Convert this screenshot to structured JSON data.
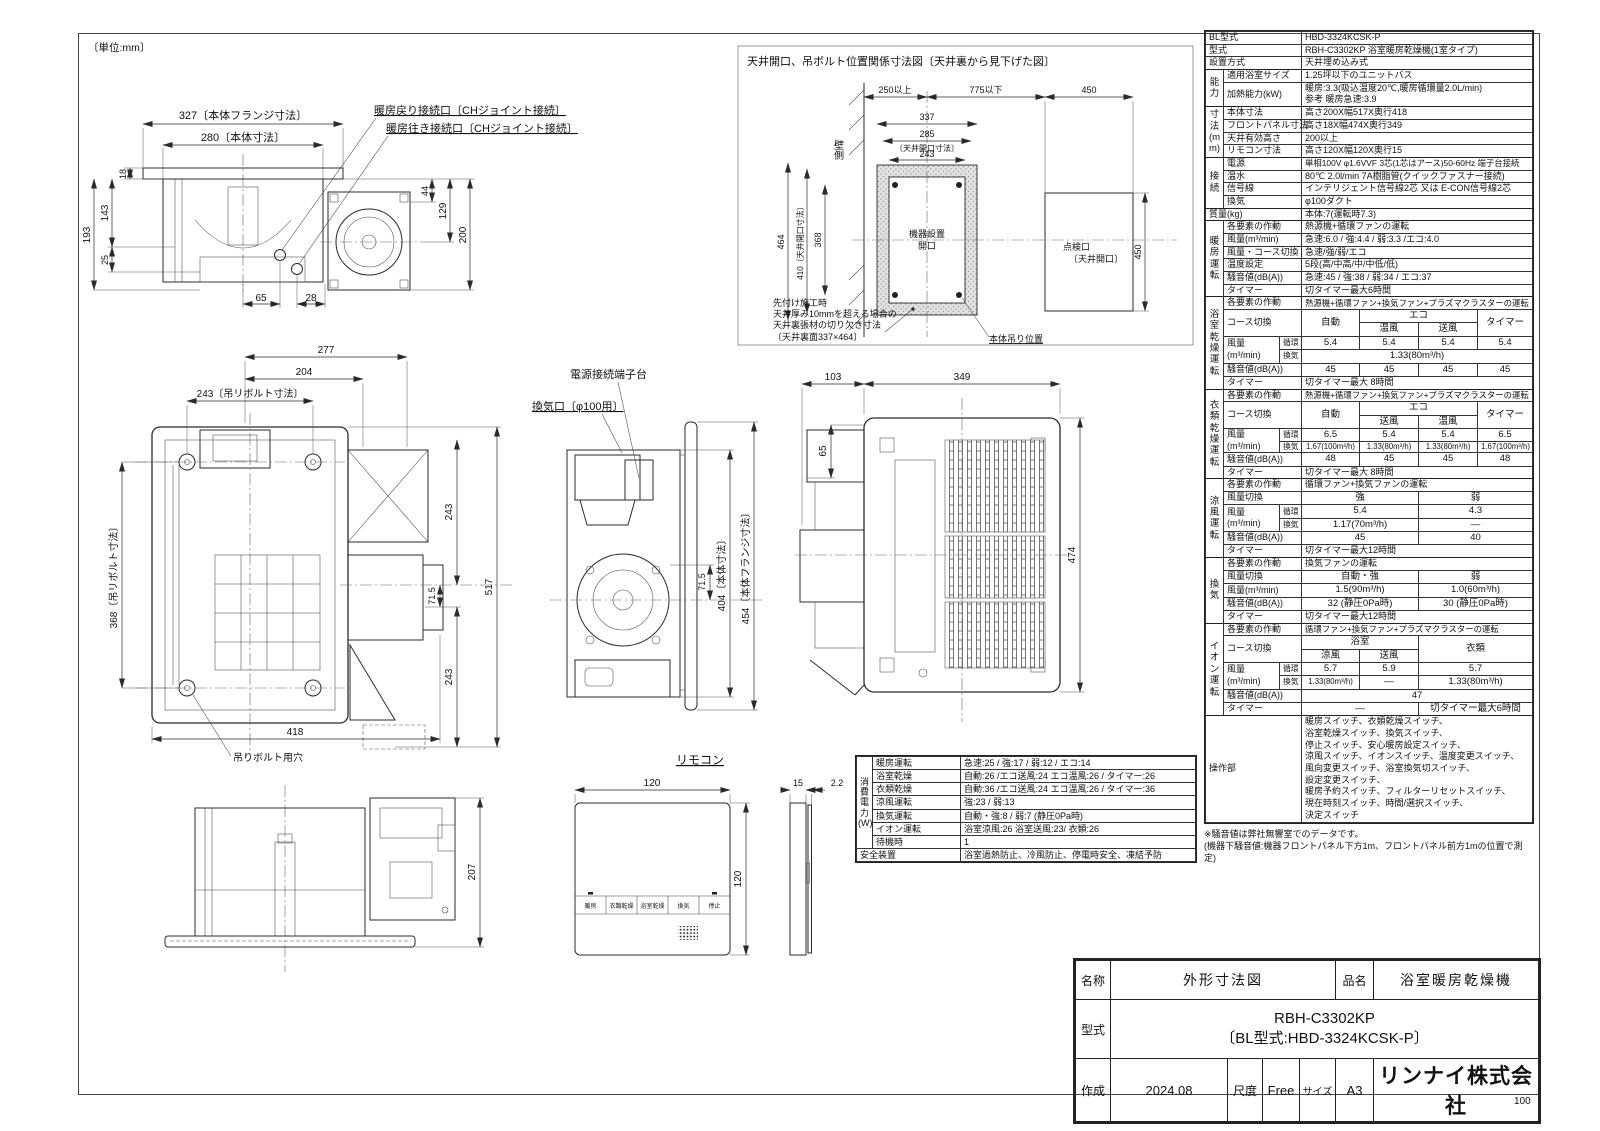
{
  "unit_note": "〔単位:mm〕",
  "page_number": "100",
  "views": {
    "front": {
      "dims": {
        "flange": "327〔本体フランジ寸法〕",
        "body": "280〔本体寸法〕",
        "d18": "18",
        "d193": "193",
        "d143": "143",
        "d25": "25",
        "d65": "65",
        "d28": "28",
        "d44": "44",
        "d129": "129",
        "d200": "200"
      },
      "labels": {
        "ch_return": "暖房戻り接続口〔CHジョイント接続〕",
        "ch_supply": "暖房往き接続口〔CHジョイント接続〕"
      }
    },
    "ceiling": {
      "title": "天井開口、吊ボルト位置関係寸法図〔天井裏から見下げた図〕",
      "dims": {
        "d250": "250以上",
        "d775": "775以下",
        "d450t": "450",
        "d337": "337",
        "d285": "285",
        "d285n": "〔天井開口寸法〕",
        "d243": "243",
        "d464": "464",
        "d410": "410〔天井開口寸法〕",
        "d368": "368",
        "d450r": "450"
      },
      "labels": {
        "wall": "壁側",
        "open1": "機器設置",
        "open2": "開口",
        "insp1": "点検口",
        "insp2": "〔天井開口〕",
        "note1": "先付け施工時",
        "note2": "天井厚み10mmを超える場合の",
        "note3": "天井裏張材の切り欠き寸法",
        "note4": "〔天井裏面337×464〕",
        "hang": "本体吊り位置"
      }
    },
    "top": {
      "dims": {
        "d277": "277",
        "d204": "204",
        "d243bolt": "243〔吊リボルト寸法〕",
        "d368bolt": "368〔吊リボルト寸法〕",
        "d418": "418",
        "d243a": "243",
        "d715": "71.5",
        "d517": "517",
        "d243b": "243"
      },
      "labels": {
        "bolt_hole": "吊りボルト用穴"
      }
    },
    "side": {
      "labels": {
        "terminal": "電源接続端子台",
        "vent": "換気口〔φ100用〕"
      },
      "dims": {
        "d715": "71.5",
        "d404": "404〔本体寸法〕",
        "d454": "454〔本体フランジ寸法〕"
      }
    },
    "panel": {
      "dims": {
        "d103": "103",
        "d349": "349",
        "d65": "65",
        "d474": "474"
      }
    },
    "side2": {
      "dims": {
        "d207": "207"
      }
    },
    "remote": {
      "title": "リモコン",
      "dims": {
        "w": "120",
        "h": "120",
        "t1": "15",
        "t2": "2.2"
      },
      "buttons": [
        "暖房",
        "衣類乾燥",
        "浴室乾燥",
        "換気",
        "停止"
      ]
    }
  },
  "spec": {
    "basic": [
      {
        "l": "BL型式",
        "v": "HBD-3324KCSK-P"
      },
      {
        "l": "型式",
        "v": "RBH-C3302KP 浴室暖房乾燥機(1室タイプ)"
      },
      {
        "l": "設置方式",
        "v": "天井埋め込み式"
      }
    ],
    "cap": {
      "g": "能力",
      "rows": [
        {
          "l": "適用浴室サイズ",
          "v": "1.25坪以下のユニットバス"
        },
        {
          "l": "加熱能力(kW)",
          "v": "暖房:3.3(吸込温度20℃,暖房循環量2.0L/min)",
          "v2": "参考 暖房急速:3.9"
        }
      ]
    },
    "dim": {
      "g": "寸法(mm)",
      "rows": [
        {
          "l": "本体寸法",
          "v": "高さ200X幅517X奥行418"
        },
        {
          "l": "フロントパネル寸法",
          "v": "高さ18X幅474X奥行349"
        },
        {
          "l": "天井有効高さ",
          "v": "200以上"
        },
        {
          "l": "リモコン寸法",
          "v": "高さ120X幅120X奥行15"
        }
      ]
    },
    "conn": {
      "g": "接続",
      "rows": [
        {
          "l": "電源",
          "v": "単相100V φ1.6VVF 3芯(1芯はアース)50-60Hz 端子台接続"
        },
        {
          "l": "温水",
          "v": "80℃ 2.0l/min 7A樹脂管(クイックファスナー接続)"
        },
        {
          "l": "信号線",
          "v": "インテリジェント信号線2芯 又は E-CON信号線2芯"
        },
        {
          "l": "換気",
          "v": "φ100ダクト"
        }
      ]
    },
    "mass": {
      "l": "質量(kg)",
      "v": "本体:7(運転時7.3)"
    },
    "heat": {
      "g": "暖房運転",
      "rows": [
        {
          "l": "各要素の作動",
          "v": "熱源機+循環ファンの運転"
        },
        {
          "l": "風量(m³/min)",
          "v": "急速:6.0 / 強:4.4 / 弱:3.3 /エコ:4.0"
        },
        {
          "l": "風量・コース切換",
          "v": "急速/強/弱/エコ"
        },
        {
          "l": "温度設定",
          "v": "5段(高/中高/中/中低/低)"
        },
        {
          "l": "騒音値(dB(A))",
          "v": "急速:45 / 強:38 / 弱:34 / エコ:37"
        },
        {
          "l": "タイマー",
          "v": "切タイマー最大6時間"
        }
      ]
    },
    "common": {
      "sakudo": "各要素の作動",
      "course": "コース切換",
      "auto": "自動",
      "eco": "エコ",
      "timer_h": "タイマー",
      "furyo": "風量",
      "fum3": "(m³/min)",
      "junkan": "循環",
      "kanki": "換気",
      "noise": "騒音値(dB(A))",
      "timer": "タイマー"
    },
    "bath": {
      "g": "浴室乾燥運転",
      "sakudo_v": "熱源機+循環ファン+換気ファン+プラズマクラスターの運転",
      "eco_a": "温風",
      "eco_b": "送風",
      "jv": [
        "5.4",
        "5.4",
        "5.4",
        "5.4"
      ],
      "kv": "1.33(80m³/h)",
      "nv": [
        "45",
        "45",
        "45",
        "45"
      ],
      "tv": "切タイマー最大 8時間"
    },
    "cloth": {
      "g": "衣類乾燥運転",
      "sakudo_v": "熱源機+循環ファン+換気ファン+プラズマクラスターの運転",
      "eco_a": "送風",
      "eco_b": "温風",
      "jv": [
        "6.5",
        "5.4",
        "5.4",
        "6.5"
      ],
      "kv": [
        "1.67(100m³/h)",
        "1.33(80m³/h)",
        "1.33(80m³/h)",
        "1.67(100m³/h)"
      ],
      "nv": [
        "48",
        "45",
        "45",
        "48"
      ],
      "tv": "切タイマー最大 8時間"
    },
    "cool": {
      "g": "涼風運転",
      "sakudo_v": "循環ファン+換気ファンの運転",
      "sw": "風量切換",
      "s1": "強",
      "s2": "弱",
      "jv": [
        "5.4",
        "4.3"
      ],
      "kv": [
        "1.17(70m³/h)",
        "—"
      ],
      "nv": [
        "45",
        "40"
      ],
      "tv": "切タイマー最大12時間"
    },
    "vent": {
      "g": "換気",
      "sakudo_v": "換気ファンの運転",
      "sw": "風量切換",
      "s1": "自動・強",
      "s2": "弱",
      "fl": "風量(m³/min)",
      "fv": [
        "1.5(90m³/h)",
        "1.0(60m³/h)"
      ],
      "nv": [
        "32 (静圧0Pa時)",
        "30 (静圧0Pa時)"
      ],
      "tv": "切タイマー最大12時間"
    },
    "ion": {
      "g": "イオン運転",
      "sakudo_v": "循環ファン+換気ファン+プラズマクラスターの運転",
      "c_bath": "浴室",
      "c1a": "涼風",
      "c1b": "送風",
      "c_cloth": "衣類",
      "jv": [
        "5.7",
        "5.9",
        "5.7"
      ],
      "kv": [
        "1.33(80m³/h)",
        "—",
        "1.33(80m³/h)"
      ],
      "nv": "47",
      "t1": "—",
      "t2": "切タイマー最大6時間"
    },
    "ctrl": {
      "l": "操作部",
      "lines": [
        "暖房スイッチ、衣類乾燥スイッチ、",
        "浴室乾燥スイッチ、換気スイッチ、",
        "停止スイッチ、安心暖房設定スイッチ、",
        "涼風スイッチ、イオンスイッチ、温度変更スイッチ、",
        "風向変更スイッチ、浴室換気切スイッチ、",
        "設定変更スイッチ、",
        "暖房予約スイッチ、フィルターリセットスイッチ、",
        "現在時刻スイッチ、時間/選択スイッチ、",
        "決定スイッチ"
      ]
    },
    "note1": "※騒音値は弊社無響室でのデータです。",
    "note2": "(機器下騒音値:機器フロントパネル下方1m、フロントパネル前方1mの位置で測定)"
  },
  "power": {
    "g": "消費電力(W)",
    "rows": [
      {
        "l": "暖房運転",
        "v": "急速:25 / 強:17 / 弱:12 / エコ:14"
      },
      {
        "l": "浴室乾燥",
        "v": "自動:26 /エコ送風:24 エコ温風:26 / タイマー:26"
      },
      {
        "l": "衣類乾燥",
        "v": "自動:36 /エコ送風:24 エコ温風:26 / タイマー:36"
      },
      {
        "l": "涼風運転",
        "v": "強:23 / 弱:13"
      },
      {
        "l": "換気運転",
        "v": "自動・強:8 / 弱:7 (静圧0Pa時)"
      },
      {
        "l": "イオン運転",
        "v": "浴室涼風:26 浴室送風:23/ 衣類:26"
      },
      {
        "l": "待機時",
        "v": "1"
      }
    ],
    "safety_l": "安全装置",
    "safety_v": "浴室過熱防止、冷風防止、停電時安全、凍結予防"
  },
  "title_block": {
    "name_label": "名称",
    "name": "外形寸法図",
    "item_label": "品名",
    "item": "浴室暖房乾燥機",
    "model_label": "型式",
    "model1": "RBH-C3302KP",
    "model2": "〔BL型式:HBD-3324KCSK-P〕",
    "date_label": "作成",
    "date": "2024.08",
    "scale_label": "尺度",
    "scale": "Free",
    "size_label": "サイズ",
    "size": "A3",
    "company": "リンナイ株式会社"
  }
}
